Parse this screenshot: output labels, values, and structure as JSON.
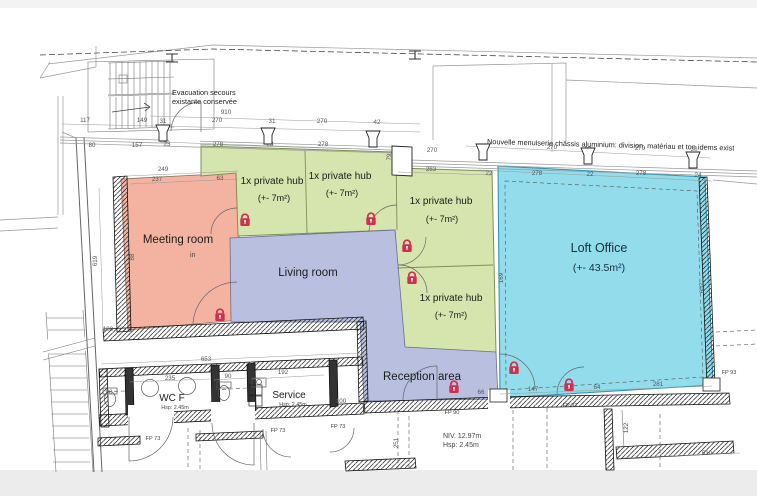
{
  "colors": {
    "meeting_room": "#f3b3a0",
    "private_hub": "#d6e4ad",
    "living_reception": "#b9bfdf",
    "loft_office": "#92dcec",
    "lock": "#d22f4e",
    "wall_line": "#1b1b1b"
  },
  "rooms": {
    "meeting": {
      "label": "Meeting room"
    },
    "living": {
      "label": "Living room"
    },
    "reception": {
      "label": "Reception area"
    },
    "loft": {
      "label": "Loft Office",
      "area": "(+- 43.5m²)"
    },
    "hub": {
      "label": "1x private hub",
      "area": "(+- 7m²)"
    },
    "wc": {
      "label": "WC F",
      "height": "Hsp: 2.45m"
    },
    "service": {
      "label": "Service",
      "height": "Hsp: 2.45m"
    }
  },
  "notes": {
    "evac_line1": "Evacuation secours",
    "evac_line2": "existante conservée",
    "menuiserie": "Nouvelle menuiserie châssis aluminium: division, matériau et ton idems exist",
    "niv": "NIV. 12.97m",
    "hsp": "Hsp: 2.45m",
    "in_mark": "in"
  },
  "plan": {
    "hub_positions": [
      {
        "lx": 272,
        "ly": 184,
        "ax": 274,
        "ay": 201
      },
      {
        "lx": 340,
        "ly": 179,
        "ax": 342,
        "ay": 196
      },
      {
        "lx": 441,
        "ly": 204,
        "ax": 442,
        "ay": 222
      },
      {
        "lx": 451,
        "ly": 301,
        "ax": 451,
        "ay": 318
      }
    ],
    "locks": [
      [
        220,
        317
      ],
      [
        245,
        222
      ],
      [
        371,
        221
      ],
      [
        407,
        248
      ],
      [
        412,
        280
      ],
      [
        454,
        389
      ],
      [
        514,
        370
      ],
      [
        569,
        387
      ]
    ],
    "posts": [
      [
        163,
        141
      ],
      [
        268,
        144
      ],
      [
        373,
        147
      ],
      [
        483,
        160
      ],
      [
        588,
        164
      ],
      [
        693,
        168
      ]
    ],
    "fp": [
      {
        "label": "FP 73",
        "x": 153,
        "y": 440
      },
      {
        "label": "FP 73",
        "x": 278,
        "y": 432
      },
      {
        "label": "FP 73",
        "x": 338,
        "y": 428
      },
      {
        "label": "FP 90",
        "x": 452,
        "y": 414
      },
      {
        "label": "FP 93",
        "x": 570,
        "y": 407
      },
      {
        "label": "FP 93",
        "x": 729,
        "y": 374
      }
    ],
    "dims": [
      [
        117,
        85,
        122
      ],
      [
        149,
        142,
        122
      ],
      [
        31,
        163,
        123
      ],
      [
        910,
        226,
        114
      ],
      [
        270,
        217,
        122
      ],
      [
        31,
        272,
        123
      ],
      [
        270,
        322,
        123
      ],
      [
        42,
        377,
        124
      ],
      [
        80,
        92,
        147
      ],
      [
        157,
        137,
        147
      ],
      [
        23,
        167,
        146
      ],
      [
        278,
        218,
        146
      ],
      [
        23,
        270,
        146
      ],
      [
        278,
        323,
        146
      ],
      [
        79,
        391,
        157,
        90
      ],
      [
        270,
        432,
        152
      ],
      [
        283,
        431,
        171
      ],
      [
        30,
        483,
        151
      ],
      [
        270,
        552,
        149
      ],
      [
        30,
        588,
        151
      ],
      [
        270,
        640,
        150
      ],
      [
        30,
        694,
        151
      ],
      [
        22,
        489,
        175
      ],
      [
        278,
        537,
        175
      ],
      [
        22,
        590,
        176
      ],
      [
        278,
        641,
        175
      ],
      [
        24,
        698,
        177
      ],
      [
        249,
        163,
        171
      ],
      [
        237,
        157,
        181
      ],
      [
        63,
        220,
        180
      ],
      [
        619,
        97,
        261,
        90
      ],
      [
        88,
        134,
        257,
        90
      ],
      [
        100,
        108,
        331
      ],
      [
        653,
        206,
        361
      ],
      [
        235,
        170,
        380
      ],
      [
        90,
        228,
        378
      ],
      [
        192,
        283,
        374
      ],
      [
        90,
        109,
        394
      ],
      [
        100,
        341,
        403
      ],
      [
        66,
        481,
        394
      ],
      [
        147,
        533,
        391
      ],
      [
        64,
        597,
        389
      ],
      [
        281,
        658,
        386
      ],
      [
        510,
        707,
        455
      ],
      [
        122,
        628,
        428,
        90
      ],
      [
        251,
        398,
        443,
        90
      ],
      [
        169,
        503,
        278,
        90
      ],
      [
        607,
        704,
        288,
        90
      ]
    ]
  }
}
